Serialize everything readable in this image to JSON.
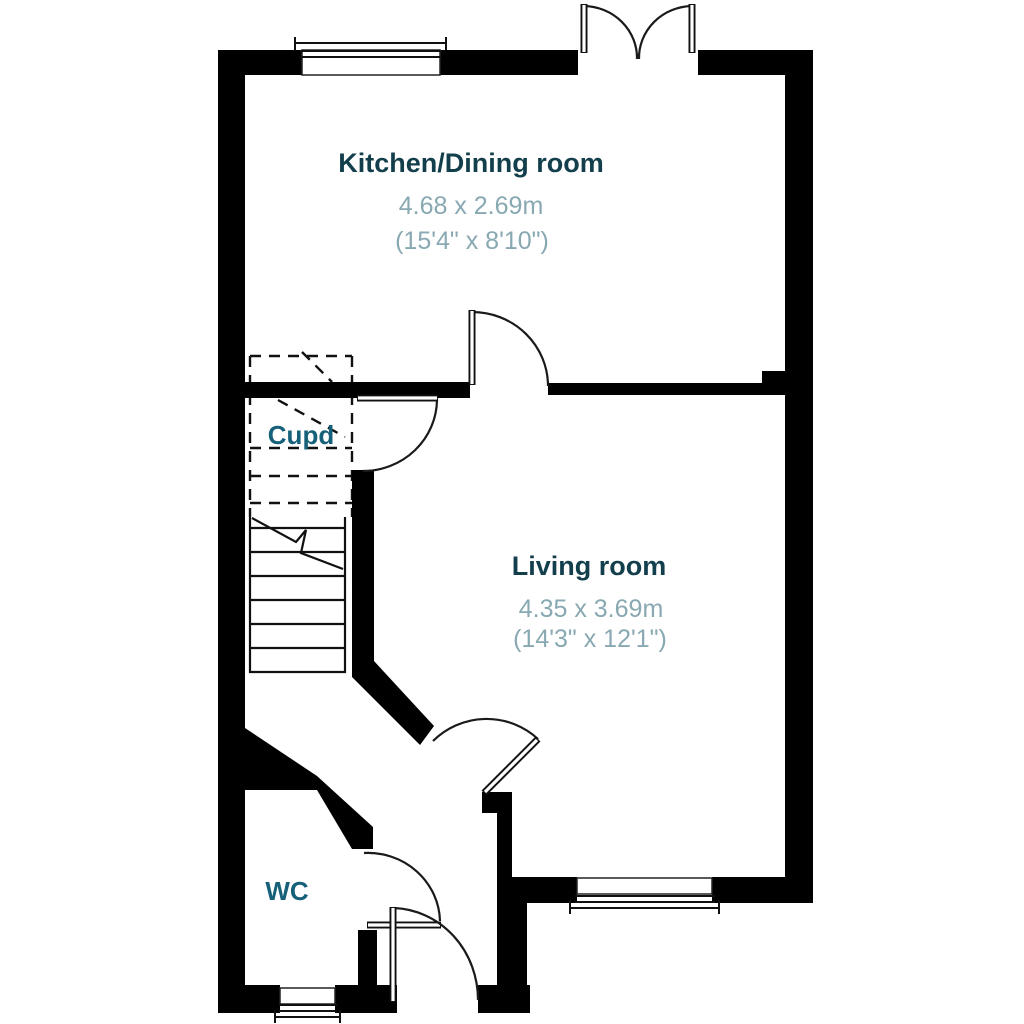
{
  "floorplan": {
    "background": "#ffffff",
    "rooms": [
      {
        "id": "kitchen-dining",
        "name": "Kitchen/Dining room",
        "metric": "4.68 x 2.69m",
        "imperial": "(15'4\" x 8'10\")"
      },
      {
        "id": "living",
        "name": "Living room",
        "metric": "4.35 x 3.69m",
        "imperial": "(14'3\" x 12'1\")"
      },
      {
        "id": "cupboard",
        "name": "Cupd"
      },
      {
        "id": "wc",
        "name": "WC"
      }
    ],
    "features": [
      "stairs",
      "under-stairs-cupboard",
      "french-doors",
      "front-door",
      "windows"
    ],
    "colors": {
      "walls": "#000000",
      "room_title": "#123f4b",
      "room_dimensions": "#88a8b2",
      "small_label": "#16607a"
    }
  }
}
